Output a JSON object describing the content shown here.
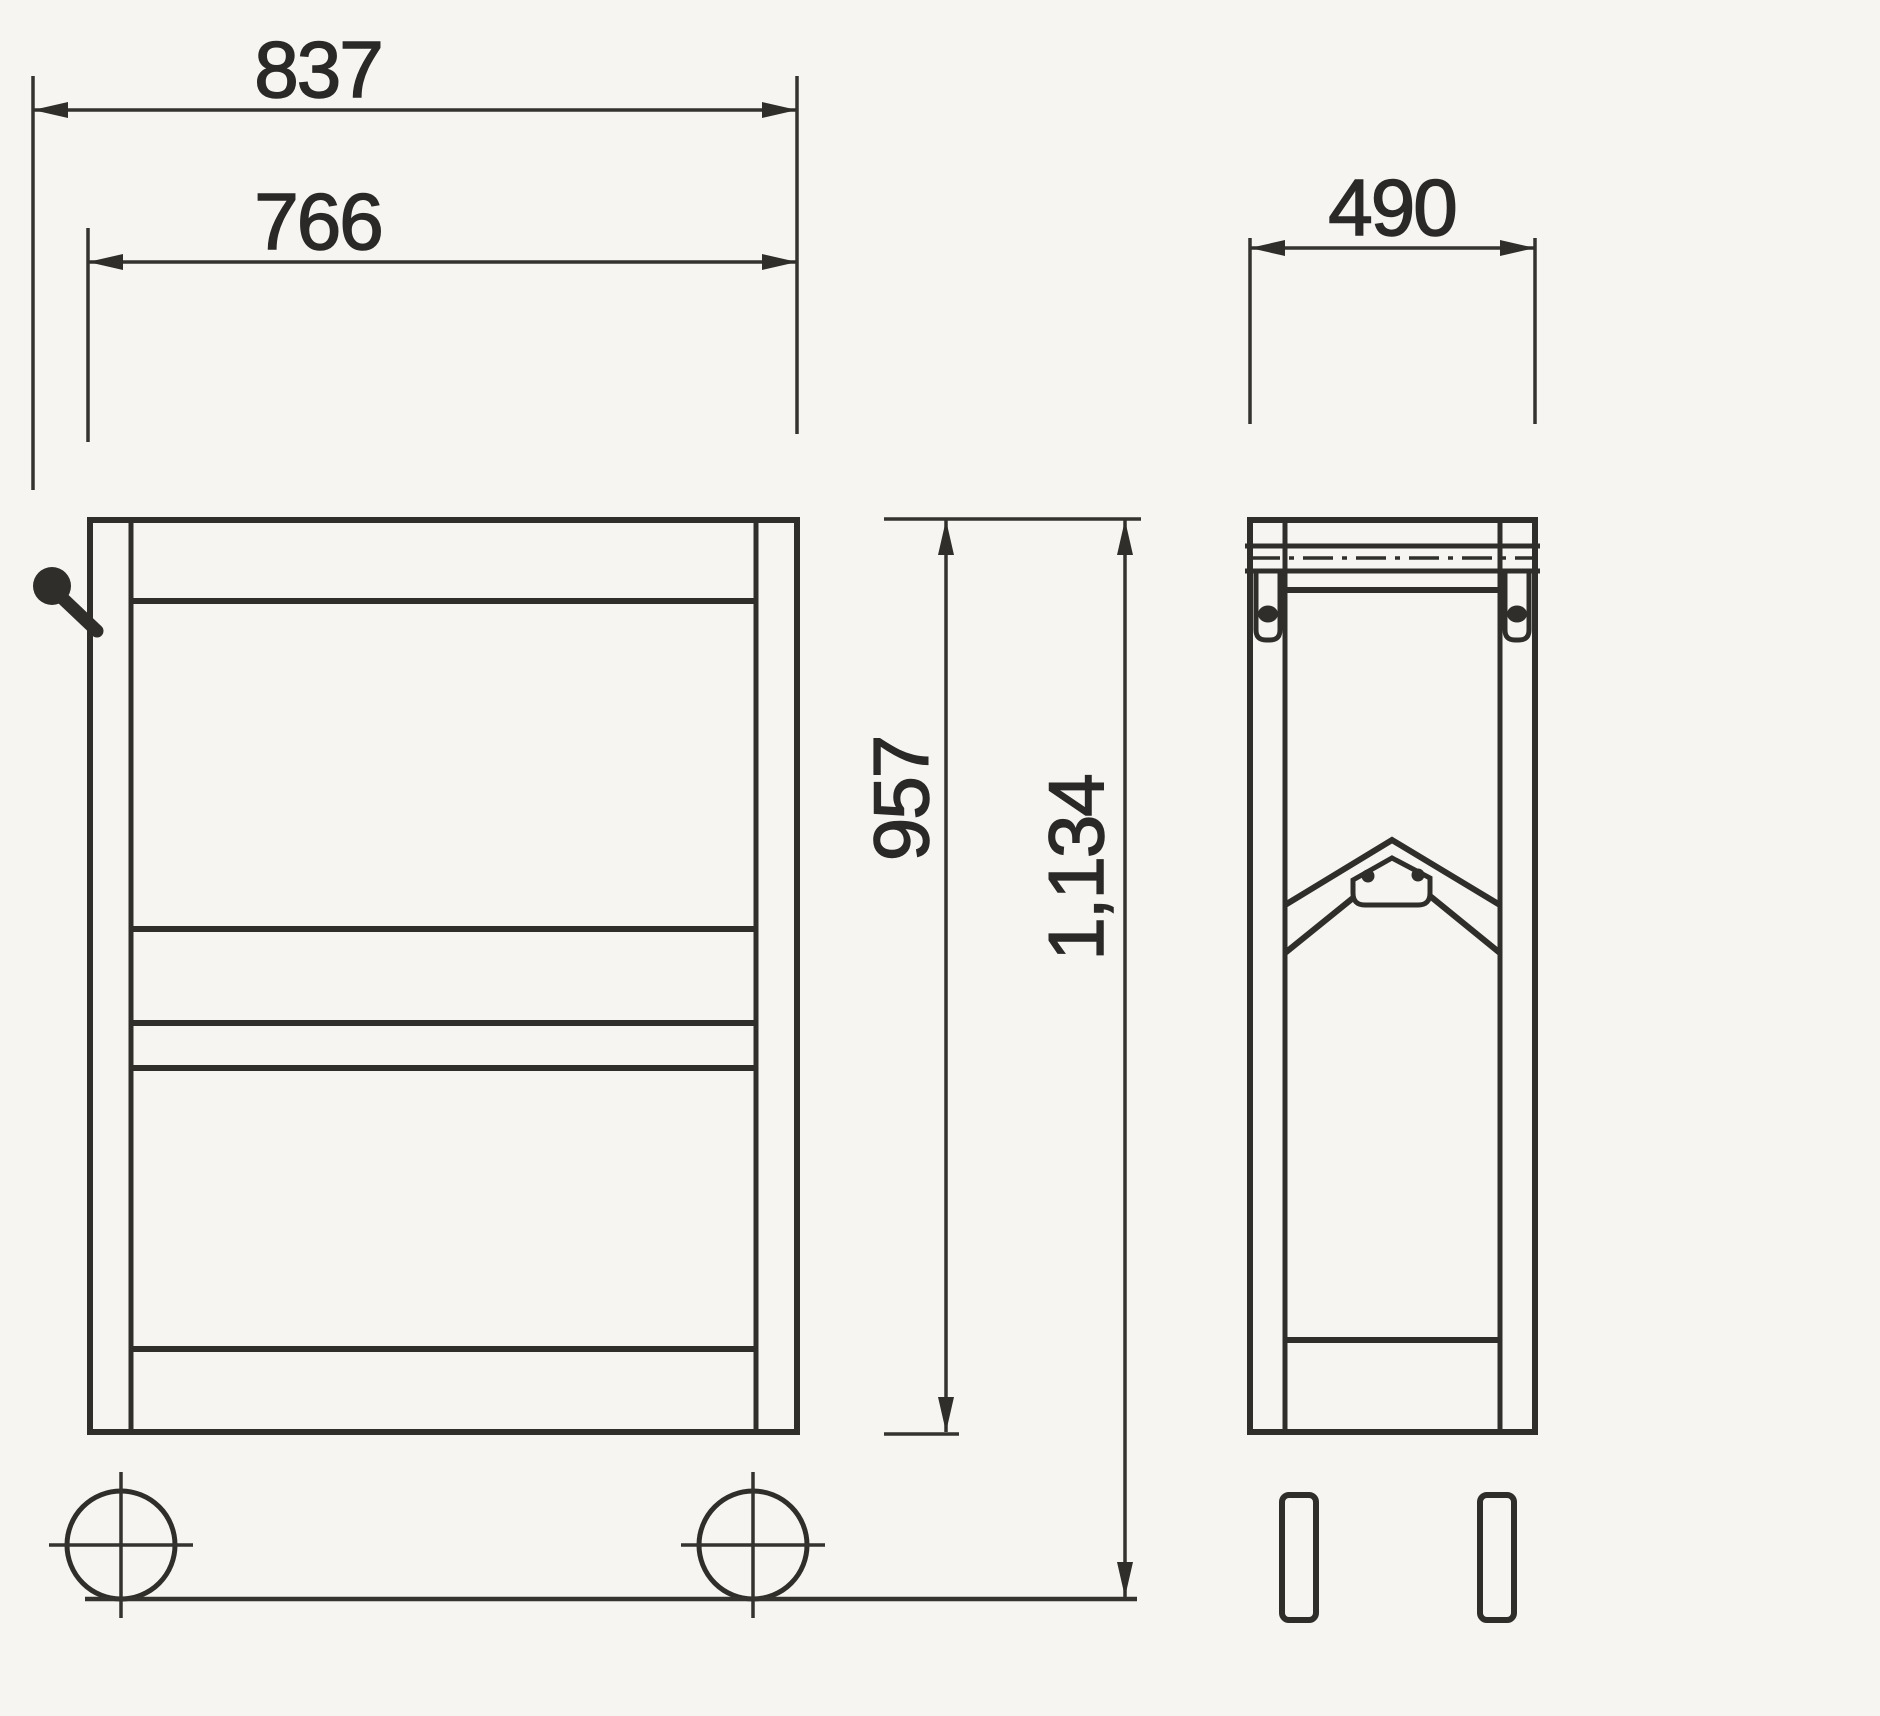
{
  "page": {
    "paper_color": "#f6f5f2",
    "ink_color": "#2f2e2b",
    "kind": "technical-dimension-drawing"
  },
  "views": {
    "front": {
      "id": "front-view"
    },
    "side": {
      "id": "side-view"
    }
  },
  "dimensions": {
    "overall_width": "837",
    "body_width": "766",
    "depth": "490",
    "body_height": "957",
    "overall_height": "1,134"
  }
}
